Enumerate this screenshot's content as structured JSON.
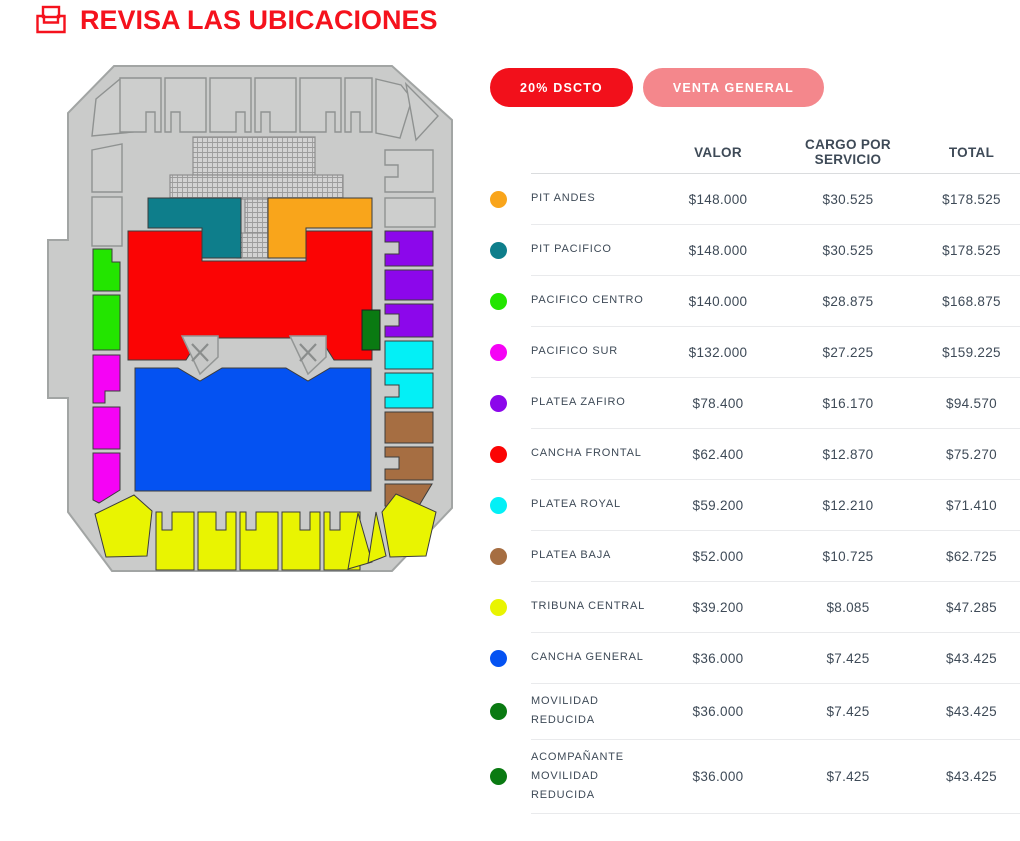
{
  "header": {
    "title": "REVISA LAS UBICACIONES"
  },
  "filters": {
    "discount": {
      "label": "20% DSCTO",
      "active": true
    },
    "general": {
      "label": "VENTA GENERAL",
      "active": false
    }
  },
  "table": {
    "columns": {
      "valor": "VALOR",
      "cargo": "CARGO POR SERVICIO",
      "total": "TOTAL"
    },
    "rows": [
      {
        "name": "PIT ANDES",
        "color": "pit_andes",
        "valor": "$148.000",
        "cargo": "$30.525",
        "total": "$178.525"
      },
      {
        "name": "PIT PACIFICO",
        "color": "pit_pacifico",
        "valor": "$148.000",
        "cargo": "$30.525",
        "total": "$178.525"
      },
      {
        "name": "PACIFICO CENTRO",
        "color": "pacifico_centro",
        "valor": "$140.000",
        "cargo": "$28.875",
        "total": "$168.875"
      },
      {
        "name": "PACIFICO SUR",
        "color": "pacifico_sur",
        "valor": "$132.000",
        "cargo": "$27.225",
        "total": "$159.225"
      },
      {
        "name": "PLATEA ZAFIRO",
        "color": "platea_zafiro",
        "valor": "$78.400",
        "cargo": "$16.170",
        "total": "$94.570"
      },
      {
        "name": "CANCHA FRONTAL",
        "color": "cancha_frontal",
        "valor": "$62.400",
        "cargo": "$12.870",
        "total": "$75.270"
      },
      {
        "name": "PLATEA ROYAL",
        "color": "platea_royal",
        "valor": "$59.200",
        "cargo": "$12.210",
        "total": "$71.410"
      },
      {
        "name": "PLATEA BAJA",
        "color": "platea_baja",
        "valor": "$52.000",
        "cargo": "$10.725",
        "total": "$62.725"
      },
      {
        "name": "TRIBUNA CENTRAL",
        "color": "tribuna_central",
        "valor": "$39.200",
        "cargo": "$8.085",
        "total": "$47.285"
      },
      {
        "name": "CANCHA GENERAL",
        "color": "cancha_general",
        "valor": "$36.000",
        "cargo": "$7.425",
        "total": "$43.425"
      },
      {
        "name": "MOVILIDAD REDUCIDA",
        "color": "movilidad",
        "valor": "$36.000",
        "cargo": "$7.425",
        "total": "$43.425"
      },
      {
        "name": "ACOMPAÑANTE MOVILIDAD REDUCIDA",
        "color": "movilidad",
        "valor": "$36.000",
        "cargo": "$7.425",
        "total": "$43.425"
      }
    ]
  },
  "colors": {
    "pit_andes": "#F9A51B",
    "pit_pacifico": "#0E7E8B",
    "pacifico_centro": "#23E500",
    "pacifico_sur": "#F503F5",
    "platea_zafiro": "#8C07EB",
    "cancha_frontal": "#FB0404",
    "platea_royal": "#03F0F6",
    "platea_baja": "#A66E42",
    "tribuna_central": "#E9F401",
    "cancha_general": "#0452F2",
    "movilidad": "#0A7A12"
  },
  "ui": {
    "accent_red": "#F2101B",
    "accent_pink": "#F4878C",
    "text_dark": "#3E4A57"
  }
}
